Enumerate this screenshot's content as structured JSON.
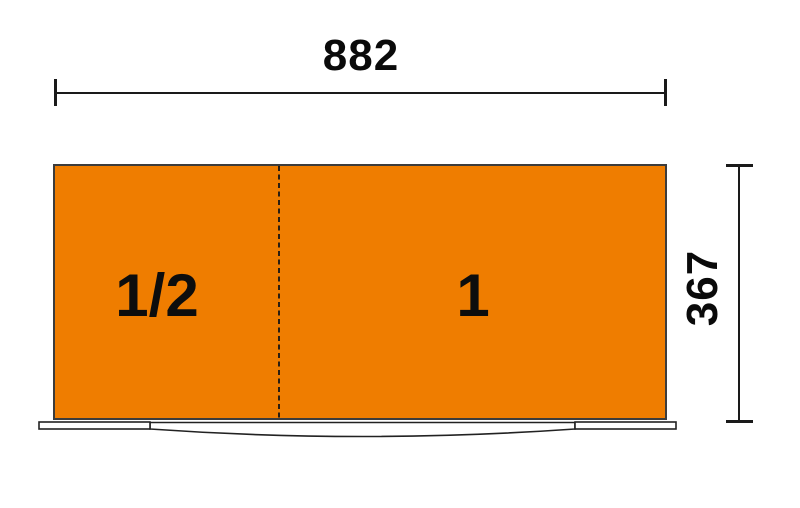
{
  "dimensions": {
    "width": {
      "value": "882"
    },
    "height": {
      "value": "367"
    }
  },
  "sections": [
    {
      "label": "1/2"
    },
    {
      "label": "1"
    }
  ],
  "colors": {
    "drawer_fill_orange": "#EF7D00",
    "drawer_outline": "#3C3C3C",
    "dimension_line": "#1A1A1A",
    "front_fill": "#FFFFFF",
    "background": "#FFFFFF"
  }
}
